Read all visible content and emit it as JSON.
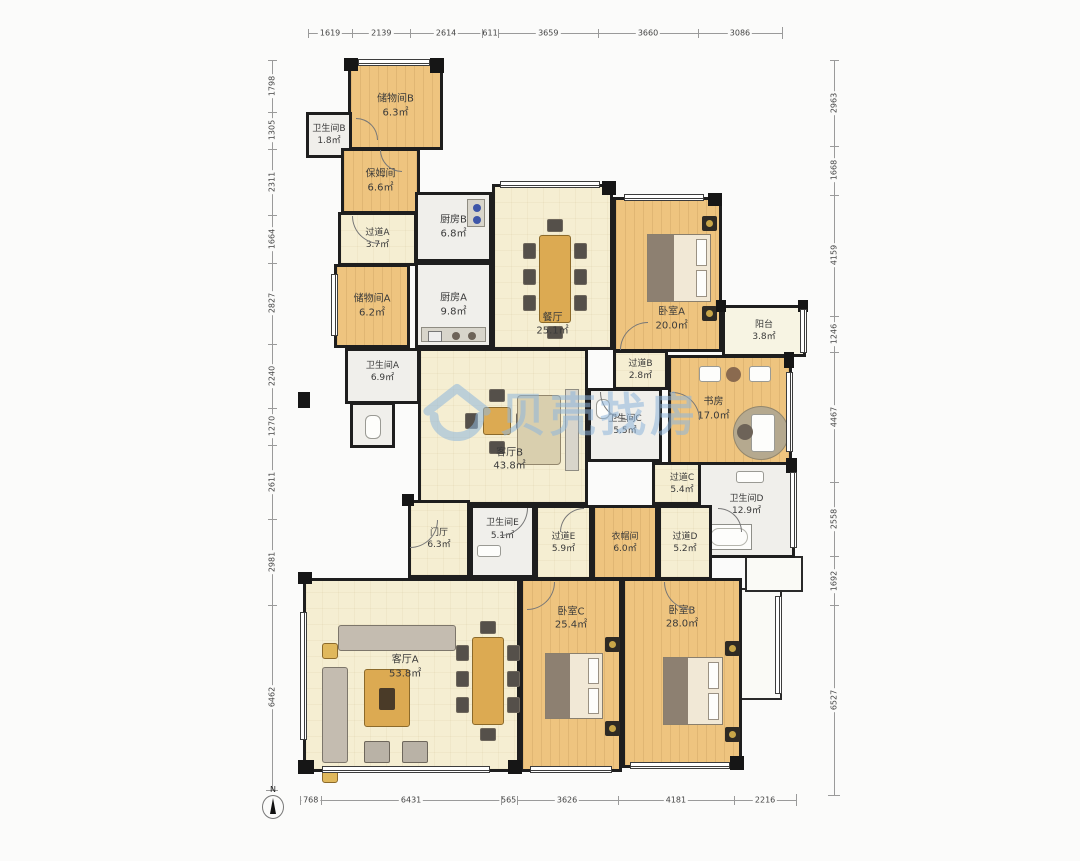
{
  "plan": {
    "north_label": "N",
    "watermark": {
      "text": "贝壳找房",
      "icon": "house-logo",
      "color": "#8fb6dc"
    },
    "rooms": [
      {
        "name": "储物间B",
        "area": "6.3㎡"
      },
      {
        "name": "卫生间B",
        "area": "1.8㎡"
      },
      {
        "name": "保姆间",
        "area": "6.6㎡"
      },
      {
        "name": "过道A",
        "area": "3.7㎡"
      },
      {
        "name": "储物间A",
        "area": "6.2㎡"
      },
      {
        "name": "厨房B",
        "area": "6.8㎡"
      },
      {
        "name": "厨房A",
        "area": "9.8㎡"
      },
      {
        "name": "餐厅",
        "area": "25.1㎡"
      },
      {
        "name": "卧室A",
        "area": "20.0㎡"
      },
      {
        "name": "阳台",
        "area": "3.8㎡"
      },
      {
        "name": "卫生间A",
        "area": "6.9㎡"
      },
      {
        "name": "过道B",
        "area": "2.8㎡"
      },
      {
        "name": "书房",
        "area": "17.0㎡"
      },
      {
        "name": "卫生间C",
        "area": "5.5㎡"
      },
      {
        "name": "客厅B",
        "area": "43.8㎡"
      },
      {
        "name": "过道C",
        "area": "5.4㎡"
      },
      {
        "name": "门厅",
        "area": "6.3㎡"
      },
      {
        "name": "卫生间E",
        "area": "5.1㎡"
      },
      {
        "name": "过道E",
        "area": "5.9㎡"
      },
      {
        "name": "衣帽间",
        "area": "6.0㎡"
      },
      {
        "name": "过道D",
        "area": "5.2㎡"
      },
      {
        "name": "卫生间D",
        "area": "12.9㎡"
      },
      {
        "name": "客厅A",
        "area": "53.8㎡"
      },
      {
        "name": "卧室C",
        "area": "25.4㎡"
      },
      {
        "name": "卧室B",
        "area": "28.0㎡"
      }
    ],
    "dims_top": [
      "1619",
      "2139",
      "2614",
      "611",
      "3659",
      "3660",
      "3086"
    ],
    "dims_bottom": [
      "768",
      "6431",
      "565",
      "3626",
      "4181",
      "2216"
    ],
    "dims_left": [
      "1798",
      "1305",
      "2311",
      "1664",
      "2827",
      "2240",
      "1270",
      "2611",
      "2981",
      "6462"
    ],
    "dims_right": [
      "2963",
      "1668",
      "4159",
      "1246",
      "4467",
      "2558",
      "1692",
      "6527"
    ]
  }
}
